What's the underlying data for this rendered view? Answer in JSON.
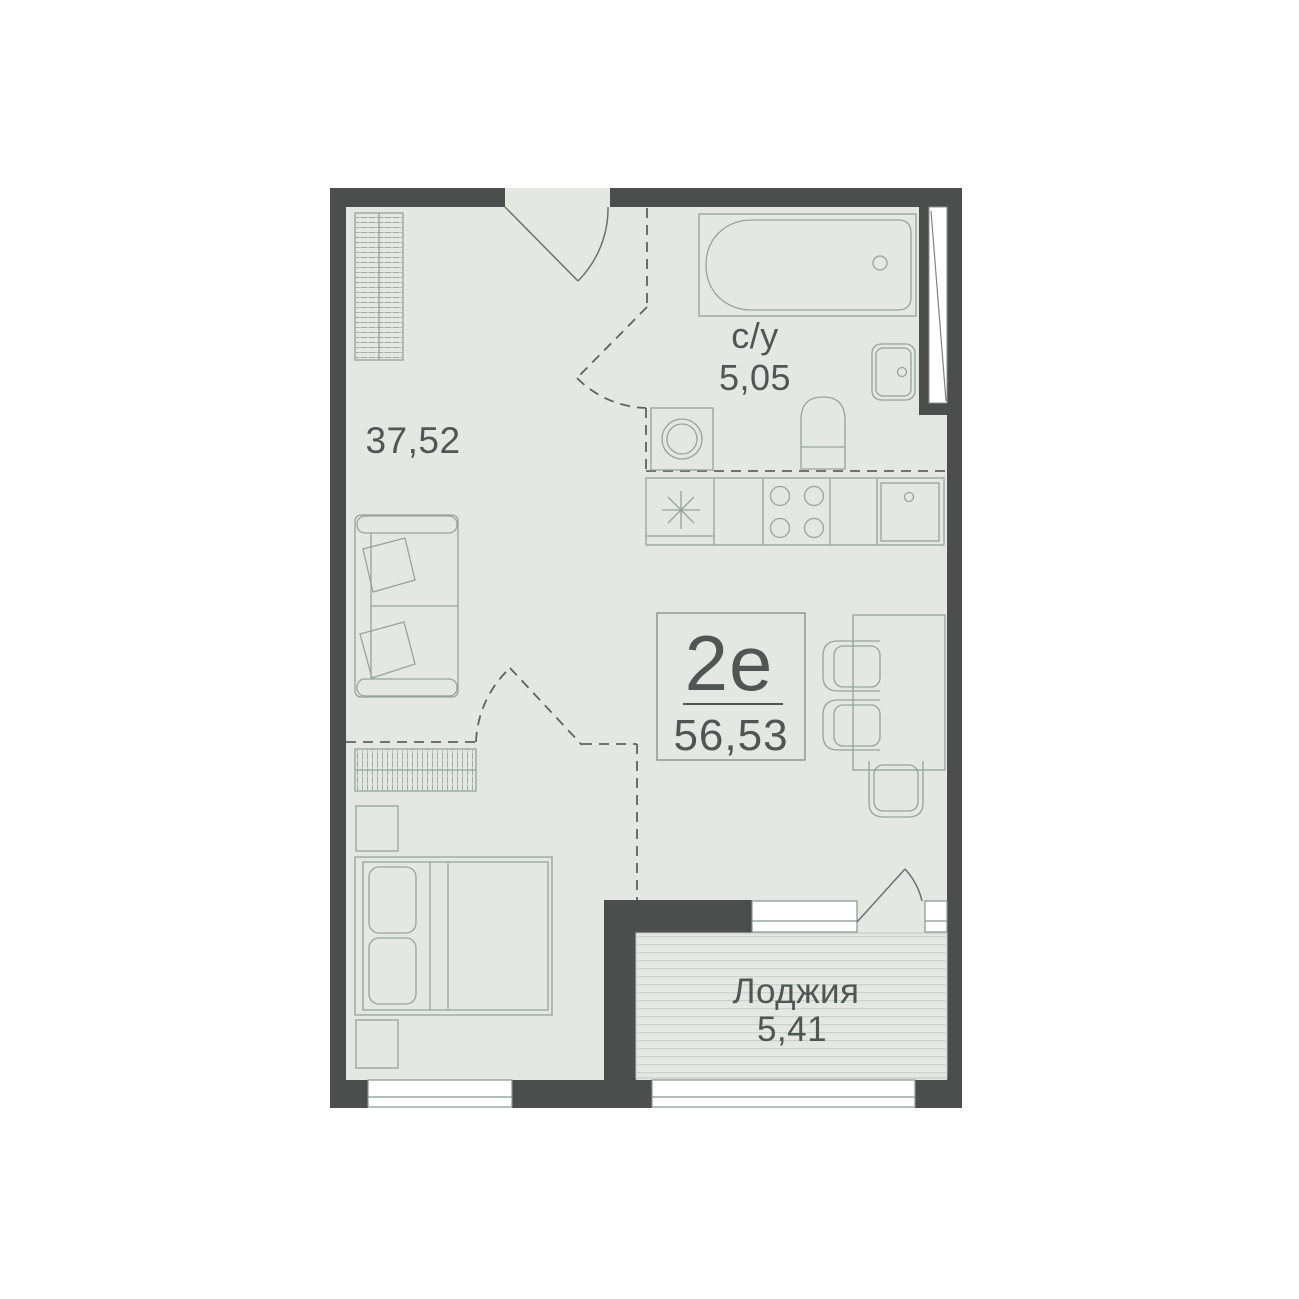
{
  "plan": {
    "unit": {
      "type_label": "2е",
      "total_area": "56,53"
    },
    "main_room": {
      "area": "37,52"
    },
    "bathroom": {
      "label": "с/у",
      "area": "5,05"
    },
    "loggia": {
      "label": "Лоджия",
      "area": "5,41"
    },
    "colors": {
      "background": "#ffffff",
      "wall": "#4c4d4d",
      "floor": "#e4e8e3",
      "furniture_line": "#98a29b",
      "door_line": "#6b7170",
      "zone_dash_line": "#5d635f",
      "window_frame": "#8b938f",
      "text": "#4f5654",
      "loggia_stripe": "#c7d0c7",
      "label_box_border": "#8f9793"
    },
    "icons": [
      "wardrobe-icon",
      "entrance-door-icon",
      "bathtub-icon",
      "bathroom-sink-icon",
      "toilet-icon",
      "washing-machine-icon",
      "vent-shaft-icon",
      "fridge-snowflake-icon",
      "stove-icon",
      "kitchen-sink-icon",
      "sofa-icon",
      "dresser-icon",
      "nightstand-icon",
      "double-bed-icon",
      "dining-table-icon",
      "chair-icon",
      "balcony-door-icon",
      "window-icon"
    ]
  }
}
